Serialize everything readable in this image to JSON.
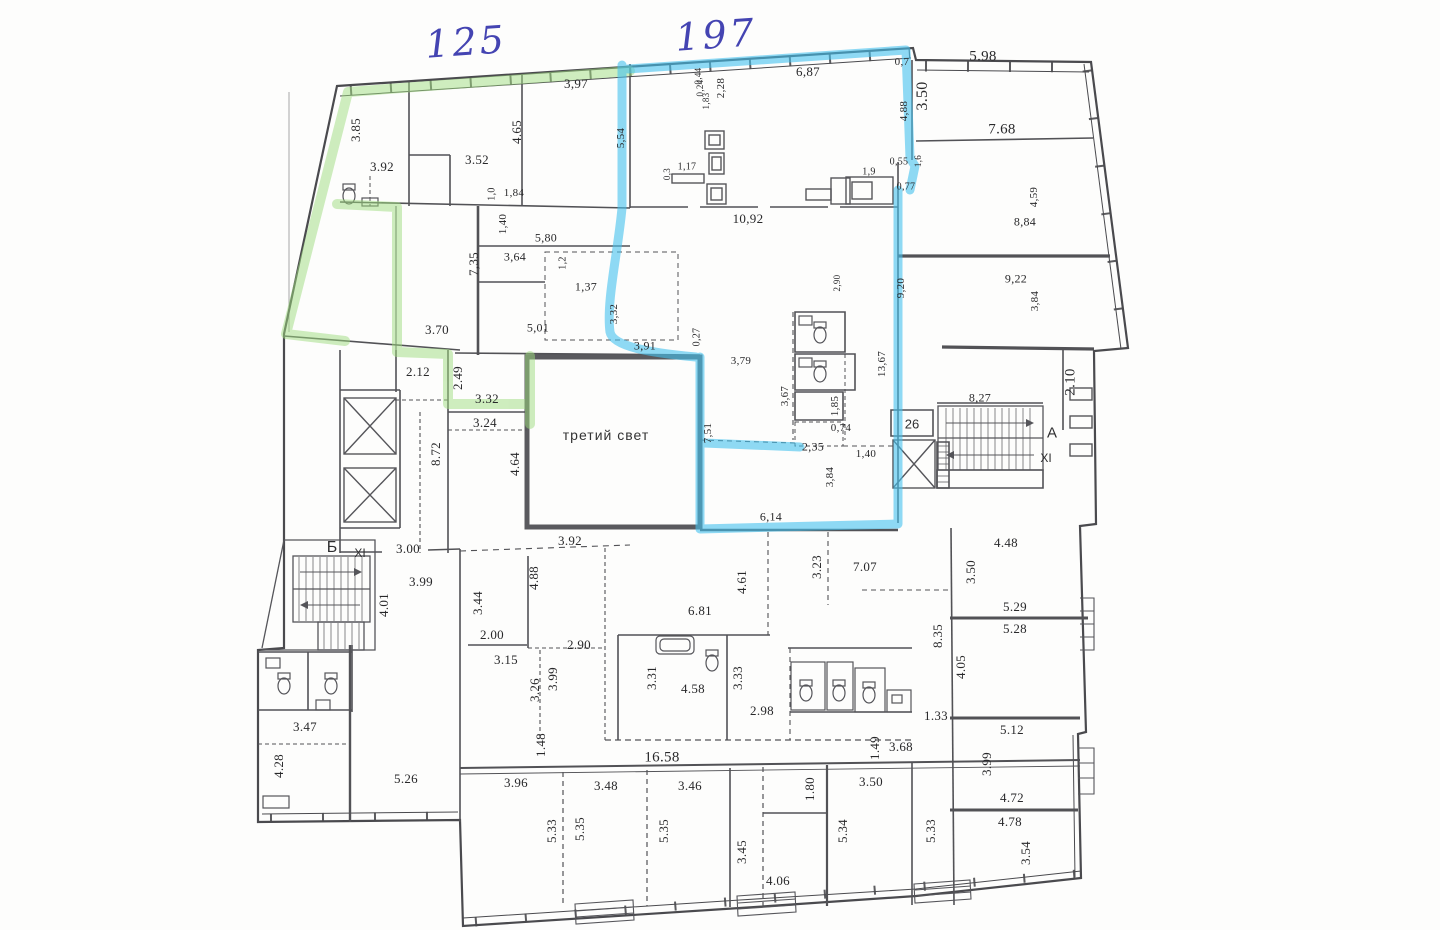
{
  "document": {
    "type": "scanned apartment floor plan",
    "room_note": "третий свет"
  },
  "colors": {
    "paper": "#fdfdfc",
    "wall_ink": "#4a4a4e",
    "highlight_green": "#9fdd7f",
    "highlight_blue": "#45c2ee",
    "handwriting_ink": "#4444b2"
  },
  "annotations": {
    "handwritten": [
      {
        "t": "125",
        "x": 466,
        "y": 42
      },
      {
        "t": "197",
        "x": 716,
        "y": 35
      }
    ],
    "rooms": [
      {
        "t": "третий свет",
        "x": 606,
        "y": 435
      }
    ],
    "zones": [
      {
        "t": "Б",
        "x": 332,
        "y": 548,
        "s": 16
      },
      {
        "t": "XI",
        "x": 360,
        "y": 553,
        "s": 12
      },
      {
        "t": "А",
        "x": 1052,
        "y": 433,
        "s": 15
      },
      {
        "t": "XI",
        "x": 1046,
        "y": 458,
        "s": 12
      },
      {
        "t": "26",
        "x": 912,
        "y": 424,
        "s": 13
      }
    ],
    "dimensions": [
      {
        "t": "3,97",
        "x": 576,
        "y": 84
      },
      {
        "t": "6,87",
        "x": 808,
        "y": 72
      },
      {
        "t": "0,7",
        "x": 902,
        "y": 62,
        "s": 11
      },
      {
        "t": "5.98",
        "x": 983,
        "y": 57,
        "s": 15
      },
      {
        "t": "3.50",
        "x": 923,
        "y": 96,
        "v": 1,
        "s": 16
      },
      {
        "t": "4,88",
        "x": 904,
        "y": 111,
        "v": 1,
        "s": 11
      },
      {
        "t": "7.68",
        "x": 1002,
        "y": 130,
        "s": 15
      },
      {
        "t": "0,44",
        "x": 698,
        "y": 76,
        "v": 1,
        "s": 9
      },
      {
        "t": "0,24",
        "x": 700,
        "y": 88,
        "v": 1,
        "s": 9
      },
      {
        "t": "1,83",
        "x": 706,
        "y": 101,
        "v": 1,
        "s": 9
      },
      {
        "t": "2,28",
        "x": 721,
        "y": 88,
        "v": 1,
        "s": 11
      },
      {
        "t": "5,54",
        "x": 621,
        "y": 138,
        "v": 1,
        "s": 11
      },
      {
        "t": "3.85",
        "x": 356,
        "y": 130,
        "v": 1
      },
      {
        "t": "4.65",
        "x": 517,
        "y": 132,
        "v": 1
      },
      {
        "t": "3.52",
        "x": 477,
        "y": 160
      },
      {
        "t": "3.92",
        "x": 382,
        "y": 167
      },
      {
        "t": "1,0",
        "x": 492,
        "y": 194,
        "v": 1,
        "s": 10
      },
      {
        "t": "1,84",
        "x": 514,
        "y": 193,
        "s": 11
      },
      {
        "t": "0,3",
        "x": 667,
        "y": 174,
        "v": 1,
        "s": 9
      },
      {
        "t": "1,17",
        "x": 687,
        "y": 167,
        "s": 10
      },
      {
        "t": "0,55",
        "x": 899,
        "y": 162,
        "s": 10
      },
      {
        "t": "1,6",
        "x": 918,
        "y": 161,
        "v": 1,
        "s": 9
      },
      {
        "t": "1,9",
        "x": 869,
        "y": 172,
        "s": 10
      },
      {
        "t": "0,77",
        "x": 906,
        "y": 187,
        "s": 10
      },
      {
        "t": "4,59",
        "x": 1034,
        "y": 197,
        "v": 1,
        "s": 11
      },
      {
        "t": "8,84",
        "x": 1025,
        "y": 222,
        "s": 12
      },
      {
        "t": "10,92",
        "x": 748,
        "y": 219,
        "s": 13
      },
      {
        "t": "1,40",
        "x": 503,
        "y": 224,
        "v": 1,
        "s": 11
      },
      {
        "t": "5,80",
        "x": 546,
        "y": 238,
        "s": 12
      },
      {
        "t": "7,35",
        "x": 474,
        "y": 264,
        "v": 1
      },
      {
        "t": "3,64",
        "x": 515,
        "y": 257,
        "s": 12
      },
      {
        "t": "1,2",
        "x": 563,
        "y": 263,
        "v": 1,
        "s": 10
      },
      {
        "t": "1,37",
        "x": 586,
        "y": 287,
        "s": 12
      },
      {
        "t": "2,90",
        "x": 837,
        "y": 283,
        "v": 1,
        "s": 9
      },
      {
        "t": "9,20",
        "x": 901,
        "y": 288,
        "v": 1,
        "s": 11
      },
      {
        "t": "9,22",
        "x": 1016,
        "y": 279,
        "s": 12
      },
      {
        "t": "3,84",
        "x": 1035,
        "y": 301,
        "v": 1,
        "s": 11
      },
      {
        "t": "3.70",
        "x": 437,
        "y": 330
      },
      {
        "t": "5,01",
        "x": 538,
        "y": 328,
        "s": 12
      },
      {
        "t": "3,32",
        "x": 614,
        "y": 314,
        "v": 1,
        "s": 11
      },
      {
        "t": "3,91",
        "x": 645,
        "y": 346,
        "s": 12
      },
      {
        "t": "0,27",
        "x": 697,
        "y": 337,
        "v": 1,
        "s": 10
      },
      {
        "t": "3,79",
        "x": 741,
        "y": 361,
        "s": 11
      },
      {
        "t": "13,67",
        "x": 882,
        "y": 364,
        "v": 1,
        "s": 11
      },
      {
        "t": "2.12",
        "x": 418,
        "y": 372
      },
      {
        "t": "2.49",
        "x": 458,
        "y": 378,
        "v": 1
      },
      {
        "t": "3.32",
        "x": 487,
        "y": 399
      },
      {
        "t": "3.24",
        "x": 485,
        "y": 423
      },
      {
        "t": "3,67",
        "x": 785,
        "y": 396,
        "v": 1,
        "s": 11
      },
      {
        "t": "1,85",
        "x": 835,
        "y": 406,
        "v": 1,
        "s": 11
      },
      {
        "t": "0,74",
        "x": 841,
        "y": 428,
        "s": 11
      },
      {
        "t": "8,27",
        "x": 980,
        "y": 398,
        "s": 12
      },
      {
        "t": "2.10",
        "x": 1071,
        "y": 382,
        "v": 1,
        "s": 15
      },
      {
        "t": "8.72",
        "x": 436,
        "y": 454,
        "v": 1
      },
      {
        "t": "4.64",
        "x": 515,
        "y": 464,
        "v": 1
      },
      {
        "t": "7,51",
        "x": 708,
        "y": 433,
        "v": 1,
        "s": 11
      },
      {
        "t": "2,35",
        "x": 813,
        "y": 447,
        "s": 12
      },
      {
        "t": "1,40",
        "x": 866,
        "y": 454,
        "s": 11
      },
      {
        "t": "3,84",
        "x": 830,
        "y": 477,
        "v": 1,
        "s": 11
      },
      {
        "t": "6,14",
        "x": 771,
        "y": 517,
        "s": 12
      },
      {
        "t": "3.00",
        "x": 408,
        "y": 549
      },
      {
        "t": "3.92",
        "x": 570,
        "y": 541
      },
      {
        "t": "3.99",
        "x": 421,
        "y": 582
      },
      {
        "t": "4.01",
        "x": 384,
        "y": 605,
        "v": 1
      },
      {
        "t": "3.44",
        "x": 478,
        "y": 603,
        "v": 1
      },
      {
        "t": "4.88",
        "x": 534,
        "y": 578,
        "v": 1
      },
      {
        "t": "4.61",
        "x": 742,
        "y": 582,
        "v": 1
      },
      {
        "t": "3.23",
        "x": 817,
        "y": 567,
        "v": 1
      },
      {
        "t": "7.07",
        "x": 865,
        "y": 567
      },
      {
        "t": "4.48",
        "x": 1006,
        "y": 543
      },
      {
        "t": "3.50",
        "x": 971,
        "y": 572,
        "v": 1
      },
      {
        "t": "2.00",
        "x": 492,
        "y": 635
      },
      {
        "t": "2.90",
        "x": 579,
        "y": 645
      },
      {
        "t": "6.81",
        "x": 700,
        "y": 611
      },
      {
        "t": "5.29",
        "x": 1015,
        "y": 607
      },
      {
        "t": "5.28",
        "x": 1015,
        "y": 629
      },
      {
        "t": "8.35",
        "x": 938,
        "y": 636,
        "v": 1
      },
      {
        "t": "4.05",
        "x": 961,
        "y": 667,
        "v": 1
      },
      {
        "t": "3.15",
        "x": 506,
        "y": 660
      },
      {
        "t": "3.26",
        "x": 535,
        "y": 690,
        "v": 1
      },
      {
        "t": "3.99",
        "x": 553,
        "y": 679,
        "v": 1
      },
      {
        "t": "3.31",
        "x": 652,
        "y": 678,
        "v": 1
      },
      {
        "t": "4.58",
        "x": 693,
        "y": 689
      },
      {
        "t": "3.33",
        "x": 738,
        "y": 678,
        "v": 1
      },
      {
        "t": "2.98",
        "x": 762,
        "y": 711
      },
      {
        "t": "1.33",
        "x": 936,
        "y": 716
      },
      {
        "t": "3.47",
        "x": 305,
        "y": 727
      },
      {
        "t": "1.48",
        "x": 541,
        "y": 745,
        "v": 1
      },
      {
        "t": "1.49",
        "x": 875,
        "y": 748,
        "v": 1
      },
      {
        "t": "3.68",
        "x": 901,
        "y": 747
      },
      {
        "t": "4.28",
        "x": 279,
        "y": 766,
        "v": 1
      },
      {
        "t": "5.26",
        "x": 406,
        "y": 779
      },
      {
        "t": "5.12",
        "x": 1012,
        "y": 730
      },
      {
        "t": "3.99",
        "x": 987,
        "y": 764,
        "v": 1
      },
      {
        "t": "16.58",
        "x": 662,
        "y": 758,
        "s": 15
      },
      {
        "t": "3.96",
        "x": 516,
        "y": 783
      },
      {
        "t": "3.48",
        "x": 606,
        "y": 786
      },
      {
        "t": "3.46",
        "x": 690,
        "y": 786
      },
      {
        "t": "3.50",
        "x": 871,
        "y": 782
      },
      {
        "t": "1.80",
        "x": 810,
        "y": 789,
        "v": 1
      },
      {
        "t": "4.72",
        "x": 1012,
        "y": 798
      },
      {
        "t": "4.78",
        "x": 1010,
        "y": 822
      },
      {
        "t": "5.33",
        "x": 552,
        "y": 831,
        "v": 1
      },
      {
        "t": "5.35",
        "x": 580,
        "y": 829,
        "v": 1
      },
      {
        "t": "5.35",
        "x": 664,
        "y": 831,
        "v": 1
      },
      {
        "t": "3.45",
        "x": 742,
        "y": 852,
        "v": 1
      },
      {
        "t": "5.34",
        "x": 843,
        "y": 831,
        "v": 1
      },
      {
        "t": "5.33",
        "x": 931,
        "y": 831,
        "v": 1
      },
      {
        "t": "3.54",
        "x": 1026,
        "y": 853,
        "v": 1
      },
      {
        "t": "4.06",
        "x": 778,
        "y": 881
      }
    ]
  }
}
